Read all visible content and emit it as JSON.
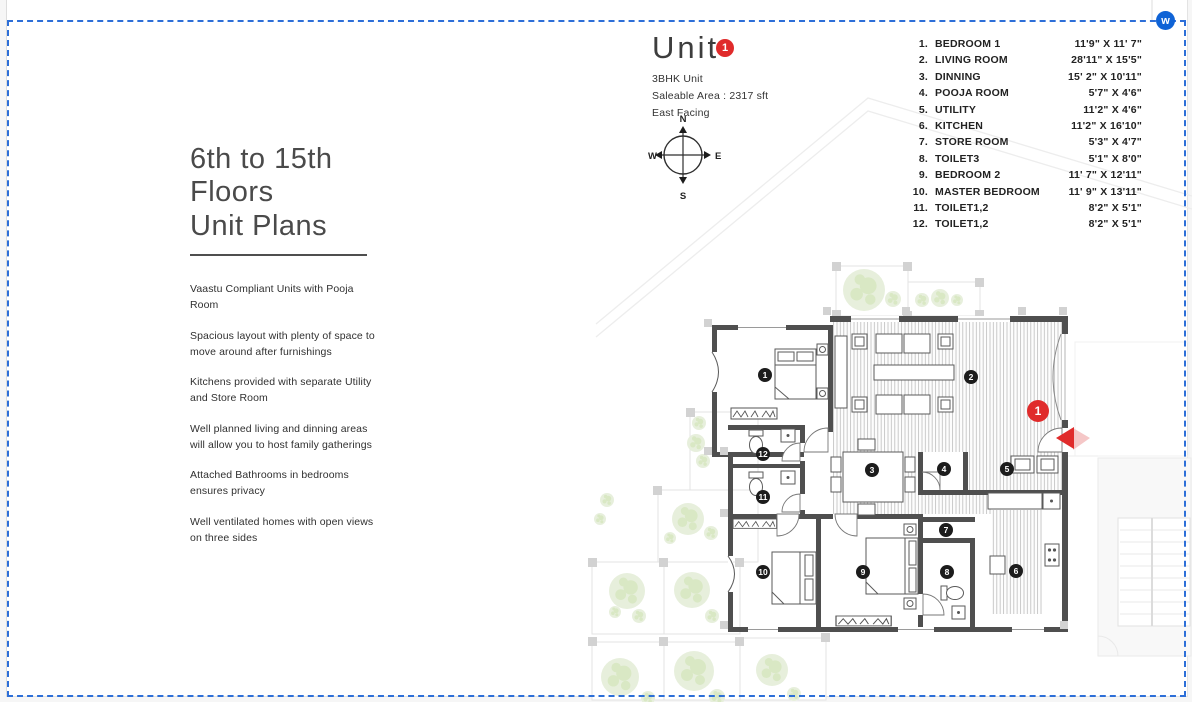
{
  "page": {
    "corner_badge": "w"
  },
  "left_panel": {
    "title_line1": "6th to 15th Floors",
    "title_line2": "Unit Plans",
    "features": [
      "Vaastu Compliant Units with Pooja Room",
      "Spacious layout with plenty of space to move around after furnishings",
      "Kitchens provided with separate Utility and Store Room",
      "Well planned living and dinning areas will allow you to host family gatherings",
      "Attached Bathrooms in bedrooms ensures privacy",
      "Well ventilated homes with open views on three sides"
    ]
  },
  "unit": {
    "title": "Unit",
    "number": "1",
    "type": "3BHK Unit",
    "area": "Saleable Area : 2317 sft",
    "facing": "East Facing"
  },
  "compass": {
    "north": "N",
    "east": "E",
    "south": "S",
    "west": "W"
  },
  "legend": {
    "rows": [
      {
        "no": "1.",
        "name": "BEDROOM 1",
        "dim": "11'9\" X 11' 7\""
      },
      {
        "no": "2.",
        "name": "LIVING ROOM",
        "dim": "28'11\" X 15'5\""
      },
      {
        "no": "3.",
        "name": "DINNING",
        "dim": "15' 2\" X 10'11\""
      },
      {
        "no": "4.",
        "name": "POOJA ROOM",
        "dim": "5'7\" X 4'6\""
      },
      {
        "no": "5.",
        "name": "UTILITY",
        "dim": "11'2\" X 4'6\""
      },
      {
        "no": "6.",
        "name": "KITCHEN",
        "dim": "11'2\" X 16'10\""
      },
      {
        "no": "7.",
        "name": "STORE ROOM",
        "dim": "5'3\" X 4'7\""
      },
      {
        "no": "8.",
        "name": "TOILET3",
        "dim": "5'1\" X 8'0\""
      },
      {
        "no": "9.",
        "name": "BEDROOM 2",
        "dim": "11' 7\" X 12'11\""
      },
      {
        "no": "10.",
        "name": "MASTER BEDROOM",
        "dim": "11' 9\" X 13'11\""
      },
      {
        "no": "11.",
        "name": "TOILET1,2",
        "dim": "8'2\" X 5'1\""
      },
      {
        "no": "12.",
        "name": "TOILET1,2",
        "dim": "8'2\" X 5'1\""
      }
    ]
  },
  "plan": {
    "entry_badge": "1",
    "markers": [
      "1",
      "2",
      "3",
      "4",
      "5",
      "6",
      "7",
      "8",
      "9",
      "10",
      "11",
      "12"
    ]
  },
  "colors": {
    "accent_red": "#e02b2b",
    "border_blue": "#2d6fd8",
    "wall": "#4f4f4f",
    "tree": "#e7efdc"
  }
}
